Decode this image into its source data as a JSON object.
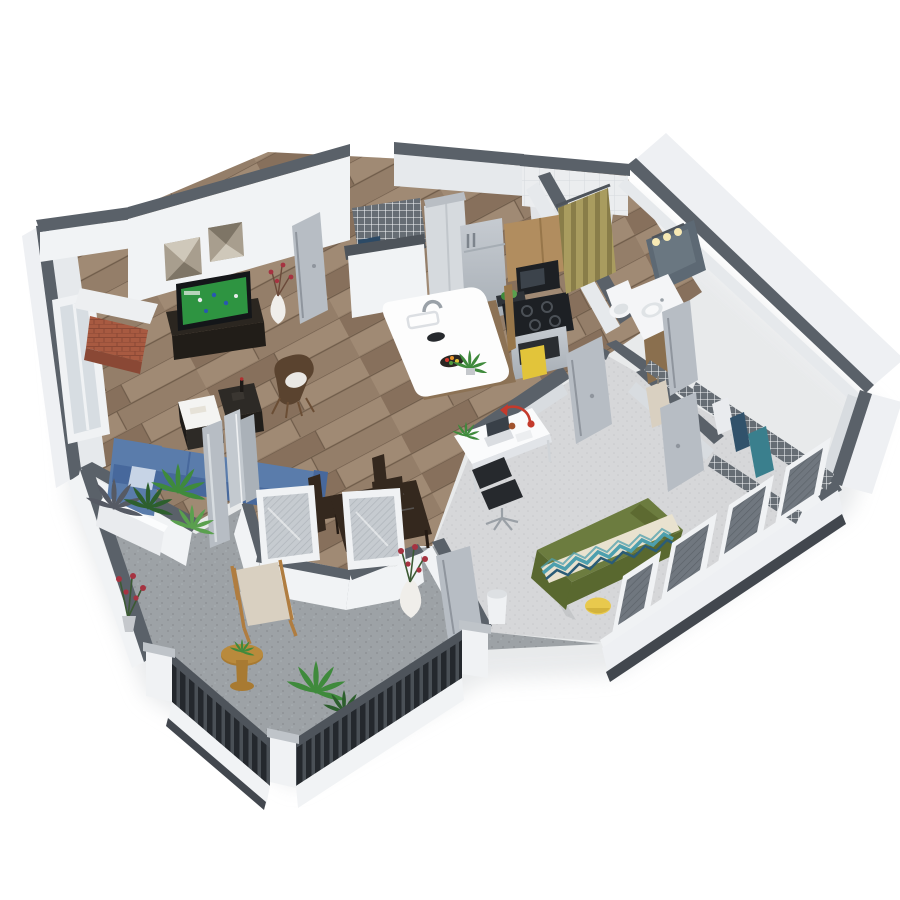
{
  "meta": {
    "description": "3D isometric cutaway floor plan rendering of a one-bedroom apartment with wrap-around balcony",
    "projection": "3d-isometric-cutaway",
    "background": "white",
    "visible_text": ""
  },
  "rooms": [
    {
      "name": "living-room",
      "floor": "hardwood",
      "items": [
        "blue-sectional-sofa",
        "light-blue-pillow",
        "tv-media-console",
        "flat-screen-tv-showing-soccer",
        "geometric-wall-art-pair",
        "corner-fireplace-with-brick",
        "coffee-table-cube-with-books",
        "coffee-table-cube-with-bottle",
        "brown-accent-chair-with-white-pillow",
        "white-vase-red-twigs",
        "tall-left-window"
      ]
    },
    {
      "name": "dining-nook",
      "floor": "hardwood",
      "items": [
        "dark-wood-dining-table",
        "two-dark-dining-chairs",
        "angled-bay-screen-windows"
      ]
    },
    {
      "name": "kitchen",
      "floor": "hardwood",
      "items": [
        "white-waterfall-island",
        "chrome-faucet",
        "black-serving-bowl",
        "fruit-platter",
        "potted-herb",
        "stainless-refrigerator",
        "tall-gray-pantry-cabinets",
        "wood-upper-cabinets",
        "microwave",
        "black-cooktop",
        "oven-with-yellow-towel",
        "wire-pantry-shelf",
        "navy-appliance"
      ]
    },
    {
      "name": "entry",
      "floor": "hardwood",
      "items": [
        "open-front-door"
      ]
    },
    {
      "name": "bathroom",
      "floor": "hardwood",
      "items": [
        "wood-vanity-with-oval-sink",
        "mirror",
        "three-bulb-vanity-light",
        "toilet",
        "tiled-shower",
        "olive-patterned-shower-curtain",
        "bathroom-door"
      ]
    },
    {
      "name": "walk-in-closet",
      "floor": "carpet",
      "items": [
        "white-wire-shelving",
        "hanging-clothes-teal-navy-white",
        "garment-bag",
        "closet-door"
      ]
    },
    {
      "name": "bedroom",
      "floor": "carpet",
      "items": [
        "bed-green-duvet",
        "chevron-runner-teal-cream-navy",
        "olive-pillow-roll",
        "yellow-ottoman",
        "white-desk",
        "laptop",
        "red-task-lamp",
        "black-office-chair",
        "white-waste-bin",
        "sliding-glass-window-wall",
        "bedroom-door"
      ]
    },
    {
      "name": "balcony",
      "floor": "concrete",
      "items": [
        "wood-armchair-beige-cushions",
        "round-wood-side-table",
        "palm-plants",
        "red-flower-shrub",
        "white-planter-box",
        "white-vase-red-flowers",
        "black-slat-railing",
        "white-corner-posts",
        "privacy-wall",
        "folding-glass-door"
      ]
    }
  ],
  "colors": {
    "shadow": "#e3e5e7",
    "wallCap": "#5a6169",
    "wallFace": "#f1f3f5",
    "wallFaceMid": "#e6e9ec",
    "wallFaceShade": "#d8dce0",
    "wallOuter": "#eef0f3",
    "baseBand": "#42474e",
    "wood1": "#947e69",
    "wood2": "#87705c",
    "wood3": "#a08a74",
    "woodLine": "#6f5c4a",
    "carpet1": "#d6d7d9",
    "carpet2": "#c7c9cc",
    "conc1": "#9da2a6",
    "conc2": "#8e9397",
    "tile1": "#ebedef",
    "tileLine": "#d6d9dd",
    "showerFl": "#e1e3e6",
    "railSlat": "#24282d",
    "railGapC": "#4a5056",
    "railPost": "#f0f2f4",
    "railCap": "#4e545b",
    "postCap": "#bfc4c9",
    "sofa": "#5a7cab",
    "sofaDark": "#47689c",
    "sofaPillow": "#c7d4e6",
    "tvFrame": "#141619",
    "tvGreen": "#2e9441",
    "console": "#2b2620",
    "artLight": "#cfc8ba",
    "artMid": "#a89e8e",
    "artDark": "#7e7566",
    "chairBrown": "#5a432f",
    "chairPillow": "#eae8e4",
    "cube": "#2d2a26",
    "tray": "#f4f4f2",
    "vase": "#f0eeea",
    "flower": "#a63341",
    "brick1": "#a85a41",
    "brick2": "#8a4835",
    "mantel": "#edeff1",
    "islandTop": "#fdfdfd",
    "islandWood": "#8c7255",
    "steel1": "#c6cbd1",
    "steel2": "#a6adb4",
    "cabWood": "#b18d5f",
    "cabWoodD": "#97764a",
    "cooktop": "#1d2024",
    "towel": "#e2c43a",
    "curt1": "#a99c5f",
    "curt2": "#897d49",
    "mirror": "#5d6974",
    "glow": "#f7e9b4",
    "porcelain": "#f4f5f7",
    "vanWood": "#8a6f4e",
    "wireBg": "#666d74",
    "wireLn": "#f5f7f9",
    "teal": "#3a7f8d",
    "navy": "#31526b",
    "white2": "#e9ebee",
    "bedGreen": "#6c7c3f",
    "bedGreenD": "#59682f",
    "pillowOl": "#5d6a31",
    "runCream": "#e9e2cf",
    "runTeal": "#4d9fae",
    "runNavy": "#2b5c77",
    "pouf": "#e8c94d",
    "deskTop": "#fafbfc",
    "deskEdge": "#e1e4e8",
    "lamp": "#c43a2c",
    "chairBlk": "#26292d",
    "laptop": "#394048",
    "doorGray": "#b7bdc4",
    "doorEdge": "#8f959d",
    "meshL": "#c6cbd0",
    "meshLn": "#afb5bb",
    "meshD": "#70777f",
    "meshDLn": "#5b6269",
    "plant1": "#3f8a3c",
    "plant2": "#2d5f2d",
    "plant3": "#5aa04e",
    "plantGray": "#565a64",
    "pot": "#c5c8cc",
    "wchair": "#b07d40",
    "cushion": "#d9d0c1",
    "stable": "#a87a32",
    "dining": "#34281e",
    "navyApp": "#2c4a66",
    "cyl": "#eff1f3"
  }
}
